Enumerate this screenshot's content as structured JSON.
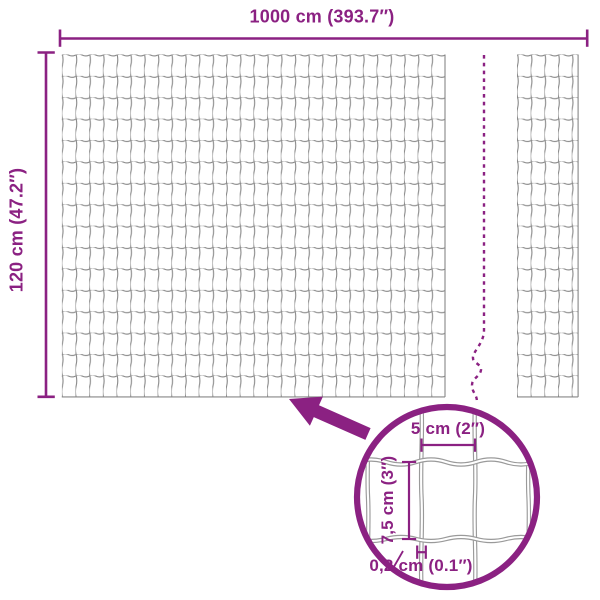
{
  "colors": {
    "accent": "#8B2182",
    "wire": "#878787"
  },
  "labels": {
    "total_width": "1000 cm (393.7″)",
    "total_height": "120 cm (47.2″)",
    "mesh_cell_width": "5 cm (2″)",
    "mesh_cell_height": "7,5 cm (3″)",
    "wire_thickness": "0,2 cm (0.1″)"
  }
}
